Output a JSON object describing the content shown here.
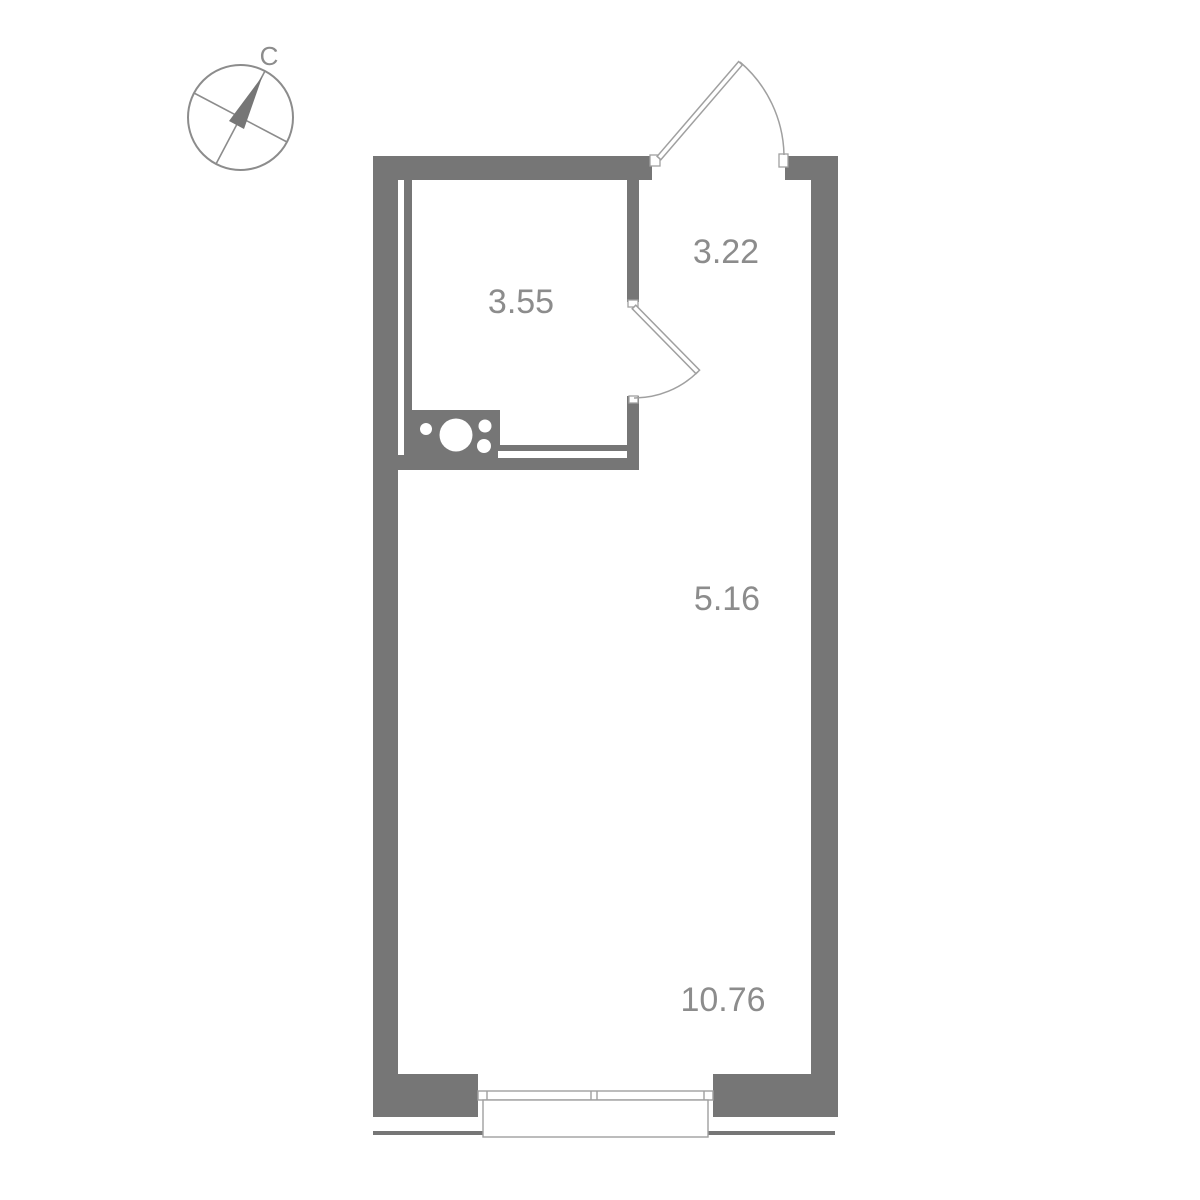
{
  "plan": {
    "type": "studio-apartment-floor-plan",
    "compass": {
      "north_label": "С"
    },
    "rooms": [
      {
        "id": "bathroom",
        "area_label": "3.55"
      },
      {
        "id": "hallway",
        "area_label": "3.22"
      },
      {
        "id": "kitchen-zone",
        "area_label": "5.16"
      },
      {
        "id": "living-zone",
        "area_label": "10.76"
      }
    ]
  },
  "colors": {
    "wall": "#767676",
    "label": "#8c8c8c",
    "thin_line": "#a0a0a0",
    "background": "#ffffff"
  }
}
